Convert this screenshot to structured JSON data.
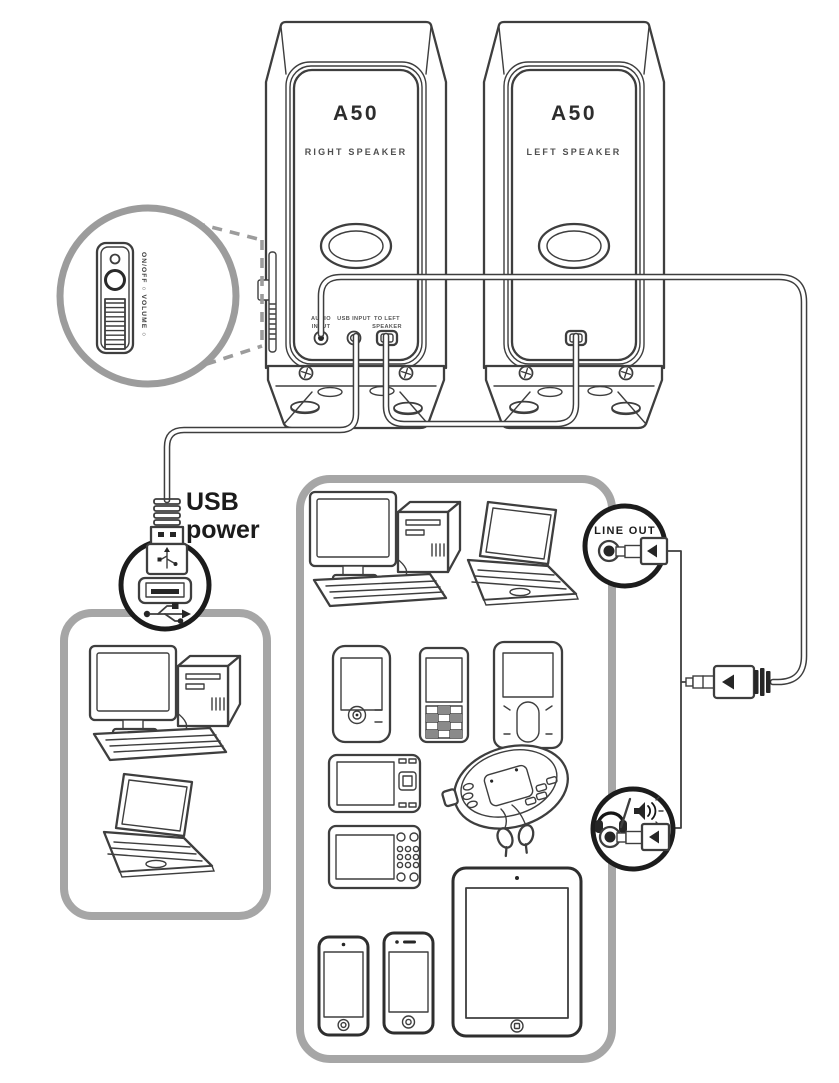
{
  "colors": {
    "line": "#3e3e3e",
    "gray_frame": "#a6a6a6",
    "callout_gray": "#9c9c9c",
    "black": "#1c1c1c"
  },
  "speakers": {
    "right": {
      "model": "A50",
      "name": "RIGHT SPEAKER"
    },
    "left": {
      "model": "A50",
      "name": "LEFT SPEAKER"
    }
  },
  "side_panel": {
    "controls_label": "ON/OFF ○ VOLUME ○"
  },
  "ports": {
    "audio_input": {
      "line1": "AUDIO",
      "line2": "INPUT"
    },
    "usb_input": {
      "label": "USB INPUT"
    },
    "to_left_speaker": {
      "line1": "TO LEFT",
      "line2": "SPEAKER"
    }
  },
  "callouts": {
    "usb_power": {
      "line1": "USB",
      "line2": "power"
    },
    "line_out": {
      "label": "LINE OUT"
    }
  }
}
